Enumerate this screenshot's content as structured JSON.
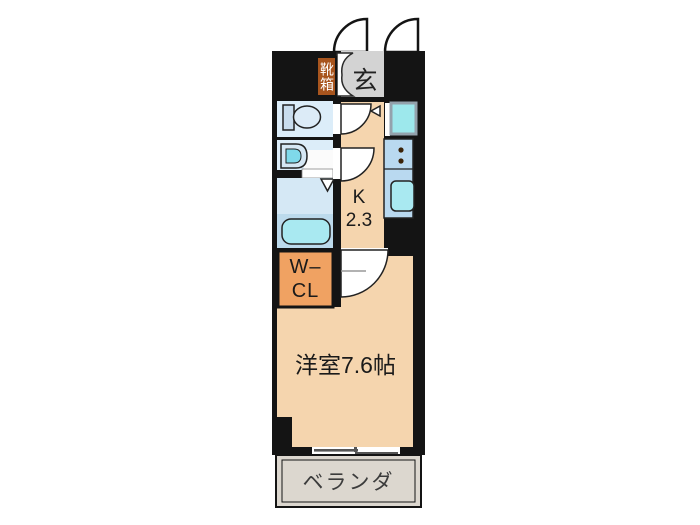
{
  "plan": {
    "entrance": {
      "label": "玄",
      "shoe_box_label": "靴箱"
    },
    "kitchen": {
      "label": "K",
      "area": "2.3"
    },
    "walk_in_closet": {
      "line1": "W–",
      "line2": "CL"
    },
    "main_room": {
      "label": "洋室7.6帖"
    },
    "balcony": {
      "label": "ベランダ"
    },
    "colors": {
      "wall": "#141414",
      "floor_peach": "#f5d5ae",
      "wet_area_blue": "#dcedf9",
      "bathroom_upper": "#d5e8f5",
      "bathroom_lower": "#bcdaec",
      "counter_blue": "#b9d9f0",
      "fixture_cyan": "#a9e9f1",
      "sink_inner_cyan": "#7fd9ea",
      "entrance_gray": "#d3d3d3",
      "balcony_gray": "#dcd7cf",
      "shoe_box_red": "#a8551e",
      "closet_orange": "#f0a262"
    }
  }
}
